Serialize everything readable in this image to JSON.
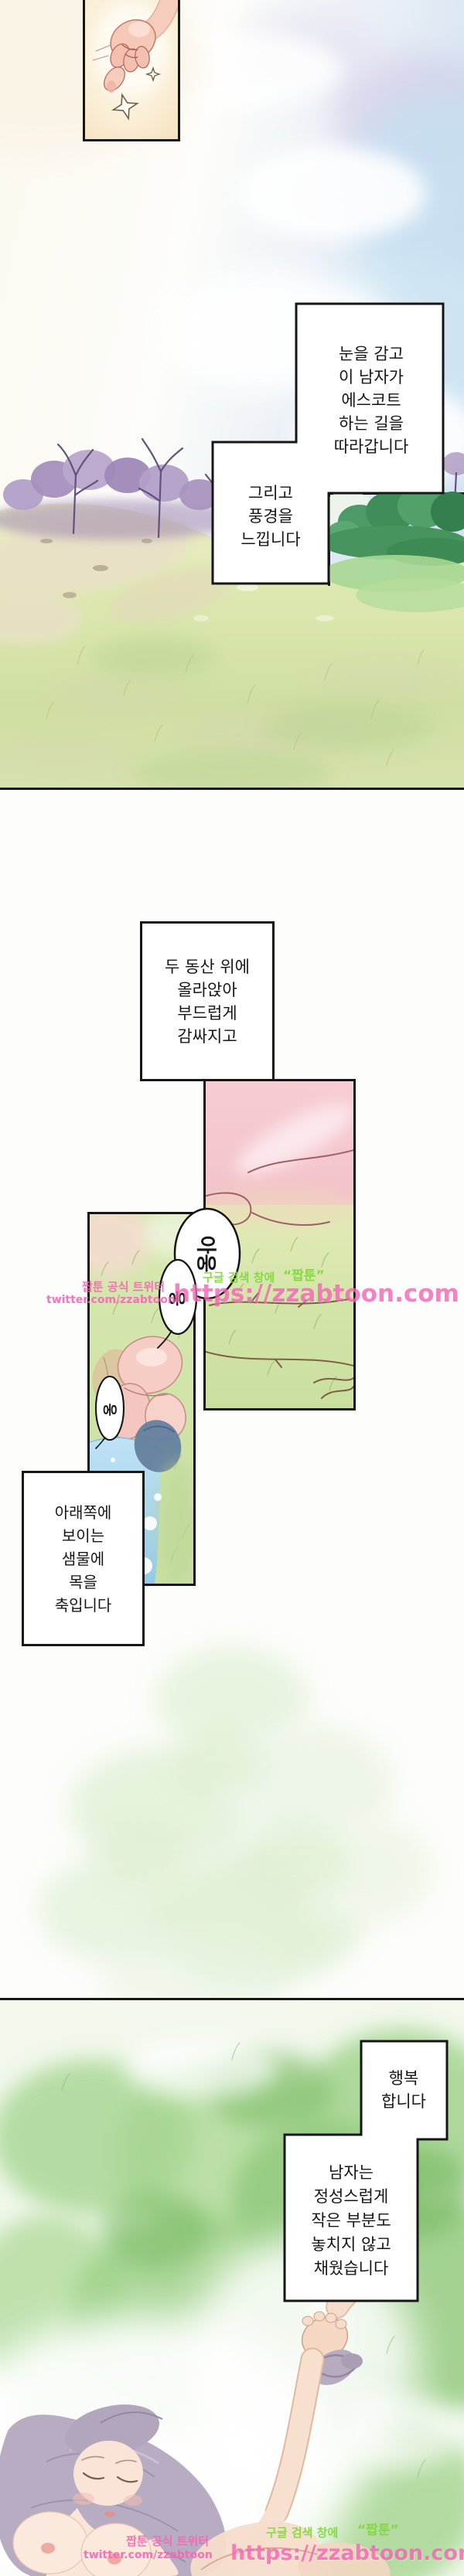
{
  "colors": {
    "ink": "#161616",
    "paper": "#fdfdfb",
    "watermark_pink": "#f464b4",
    "watermark_green": "#7fd938",
    "sky_blue": "#cfe4f3",
    "tree_purple": "#b2a0c8",
    "grass_green": "#cfdfa2",
    "water_blue": "#a9d3ee",
    "skin_pink": "#f5cdc5"
  },
  "captions": {
    "escort": {
      "lines": [
        "눈을 감고",
        "이 남자가",
        "에스코트",
        "하는 길을",
        "따라갑니다"
      ]
    },
    "scenery": {
      "lines": [
        "그리고",
        "풍경을",
        "느낍니다"
      ]
    },
    "hills": {
      "lines": [
        "두 동산 위에",
        "올라앉아",
        "부드럽게",
        "감싸지고"
      ]
    },
    "spring": {
      "lines": [
        "아래쪽에",
        "보이는",
        "샘물에",
        "목을",
        "축입니다"
      ]
    },
    "happy": {
      "lines": [
        "행복",
        "합니다"
      ]
    },
    "devotion": {
      "lines": [
        "남자는",
        "정성스럽게",
        "작은 부분도",
        "놓치지 않고",
        "채웠습니다"
      ]
    }
  },
  "bubbles": {
    "moan_long": "아웅",
    "moan_short_1": "웅",
    "moan_short_2": "웅"
  },
  "watermark": {
    "official_label": "짭툰 공식 트위터",
    "twitter_url": "twitter.com/zzabtoon",
    "search_hint": "구글 검색 창에",
    "search_term": "“짭툰”",
    "site_url": "https://zzabtoon.com"
  }
}
